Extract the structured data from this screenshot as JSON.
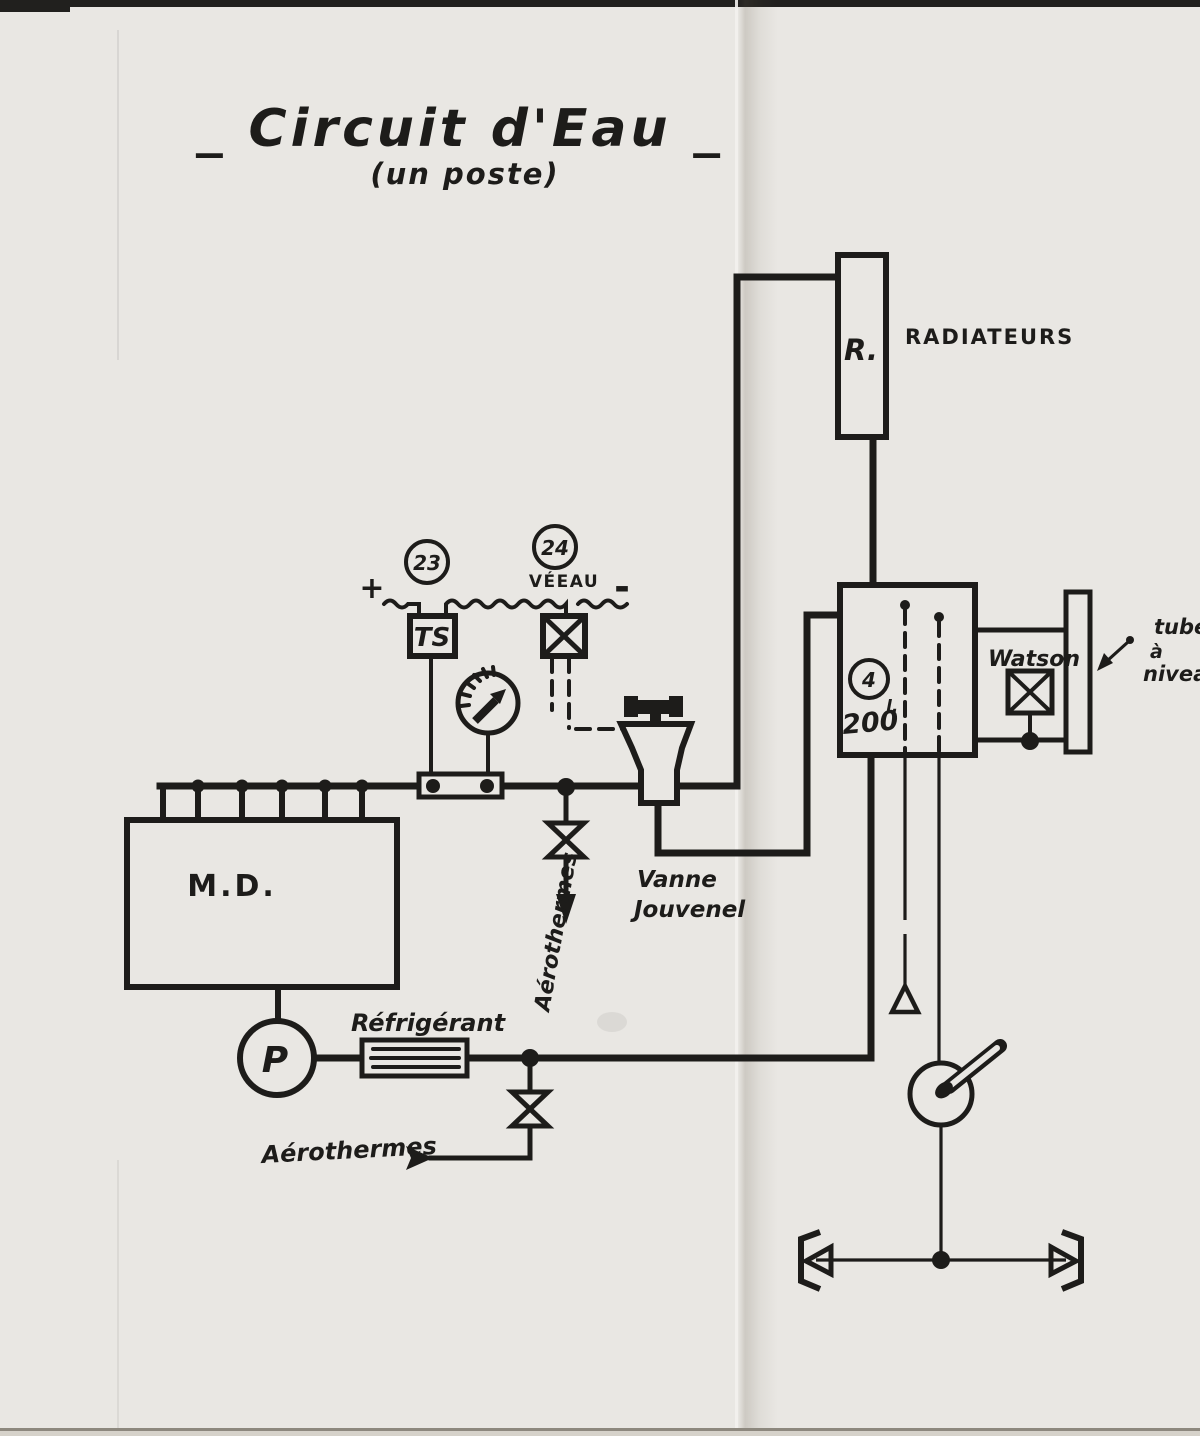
{
  "title": {
    "main": "_ Circuit d'Eau _",
    "subtitle": "(un poste)"
  },
  "colors": {
    "ink": "#1d1c1a",
    "paper": "#e9e7e3"
  },
  "electrical": {
    "plus": "+",
    "minus": "-",
    "sensor_circle": "23",
    "valve_circle": "24",
    "valve_label": "VÉEAU",
    "thermostat": "TS"
  },
  "components": {
    "radiator_tag": "R.",
    "radiator_label": "RADIATEURS",
    "engine": "M.D.",
    "pump": "P",
    "cooler": "Réfrigérant",
    "aerotherms_mid": "Aérothermes",
    "aerotherms_low": "Aérothermes",
    "jouvenel_line1": "Vanne",
    "jouvenel_line2": "Jouvenel",
    "tank_circle": "4",
    "tank_capacity": "200",
    "tank_capacity_unit": "l.",
    "drain_valve": "Watson",
    "level_tube_line1": "tube",
    "level_tube_line2": "à",
    "level_tube_line3": "niveau"
  }
}
